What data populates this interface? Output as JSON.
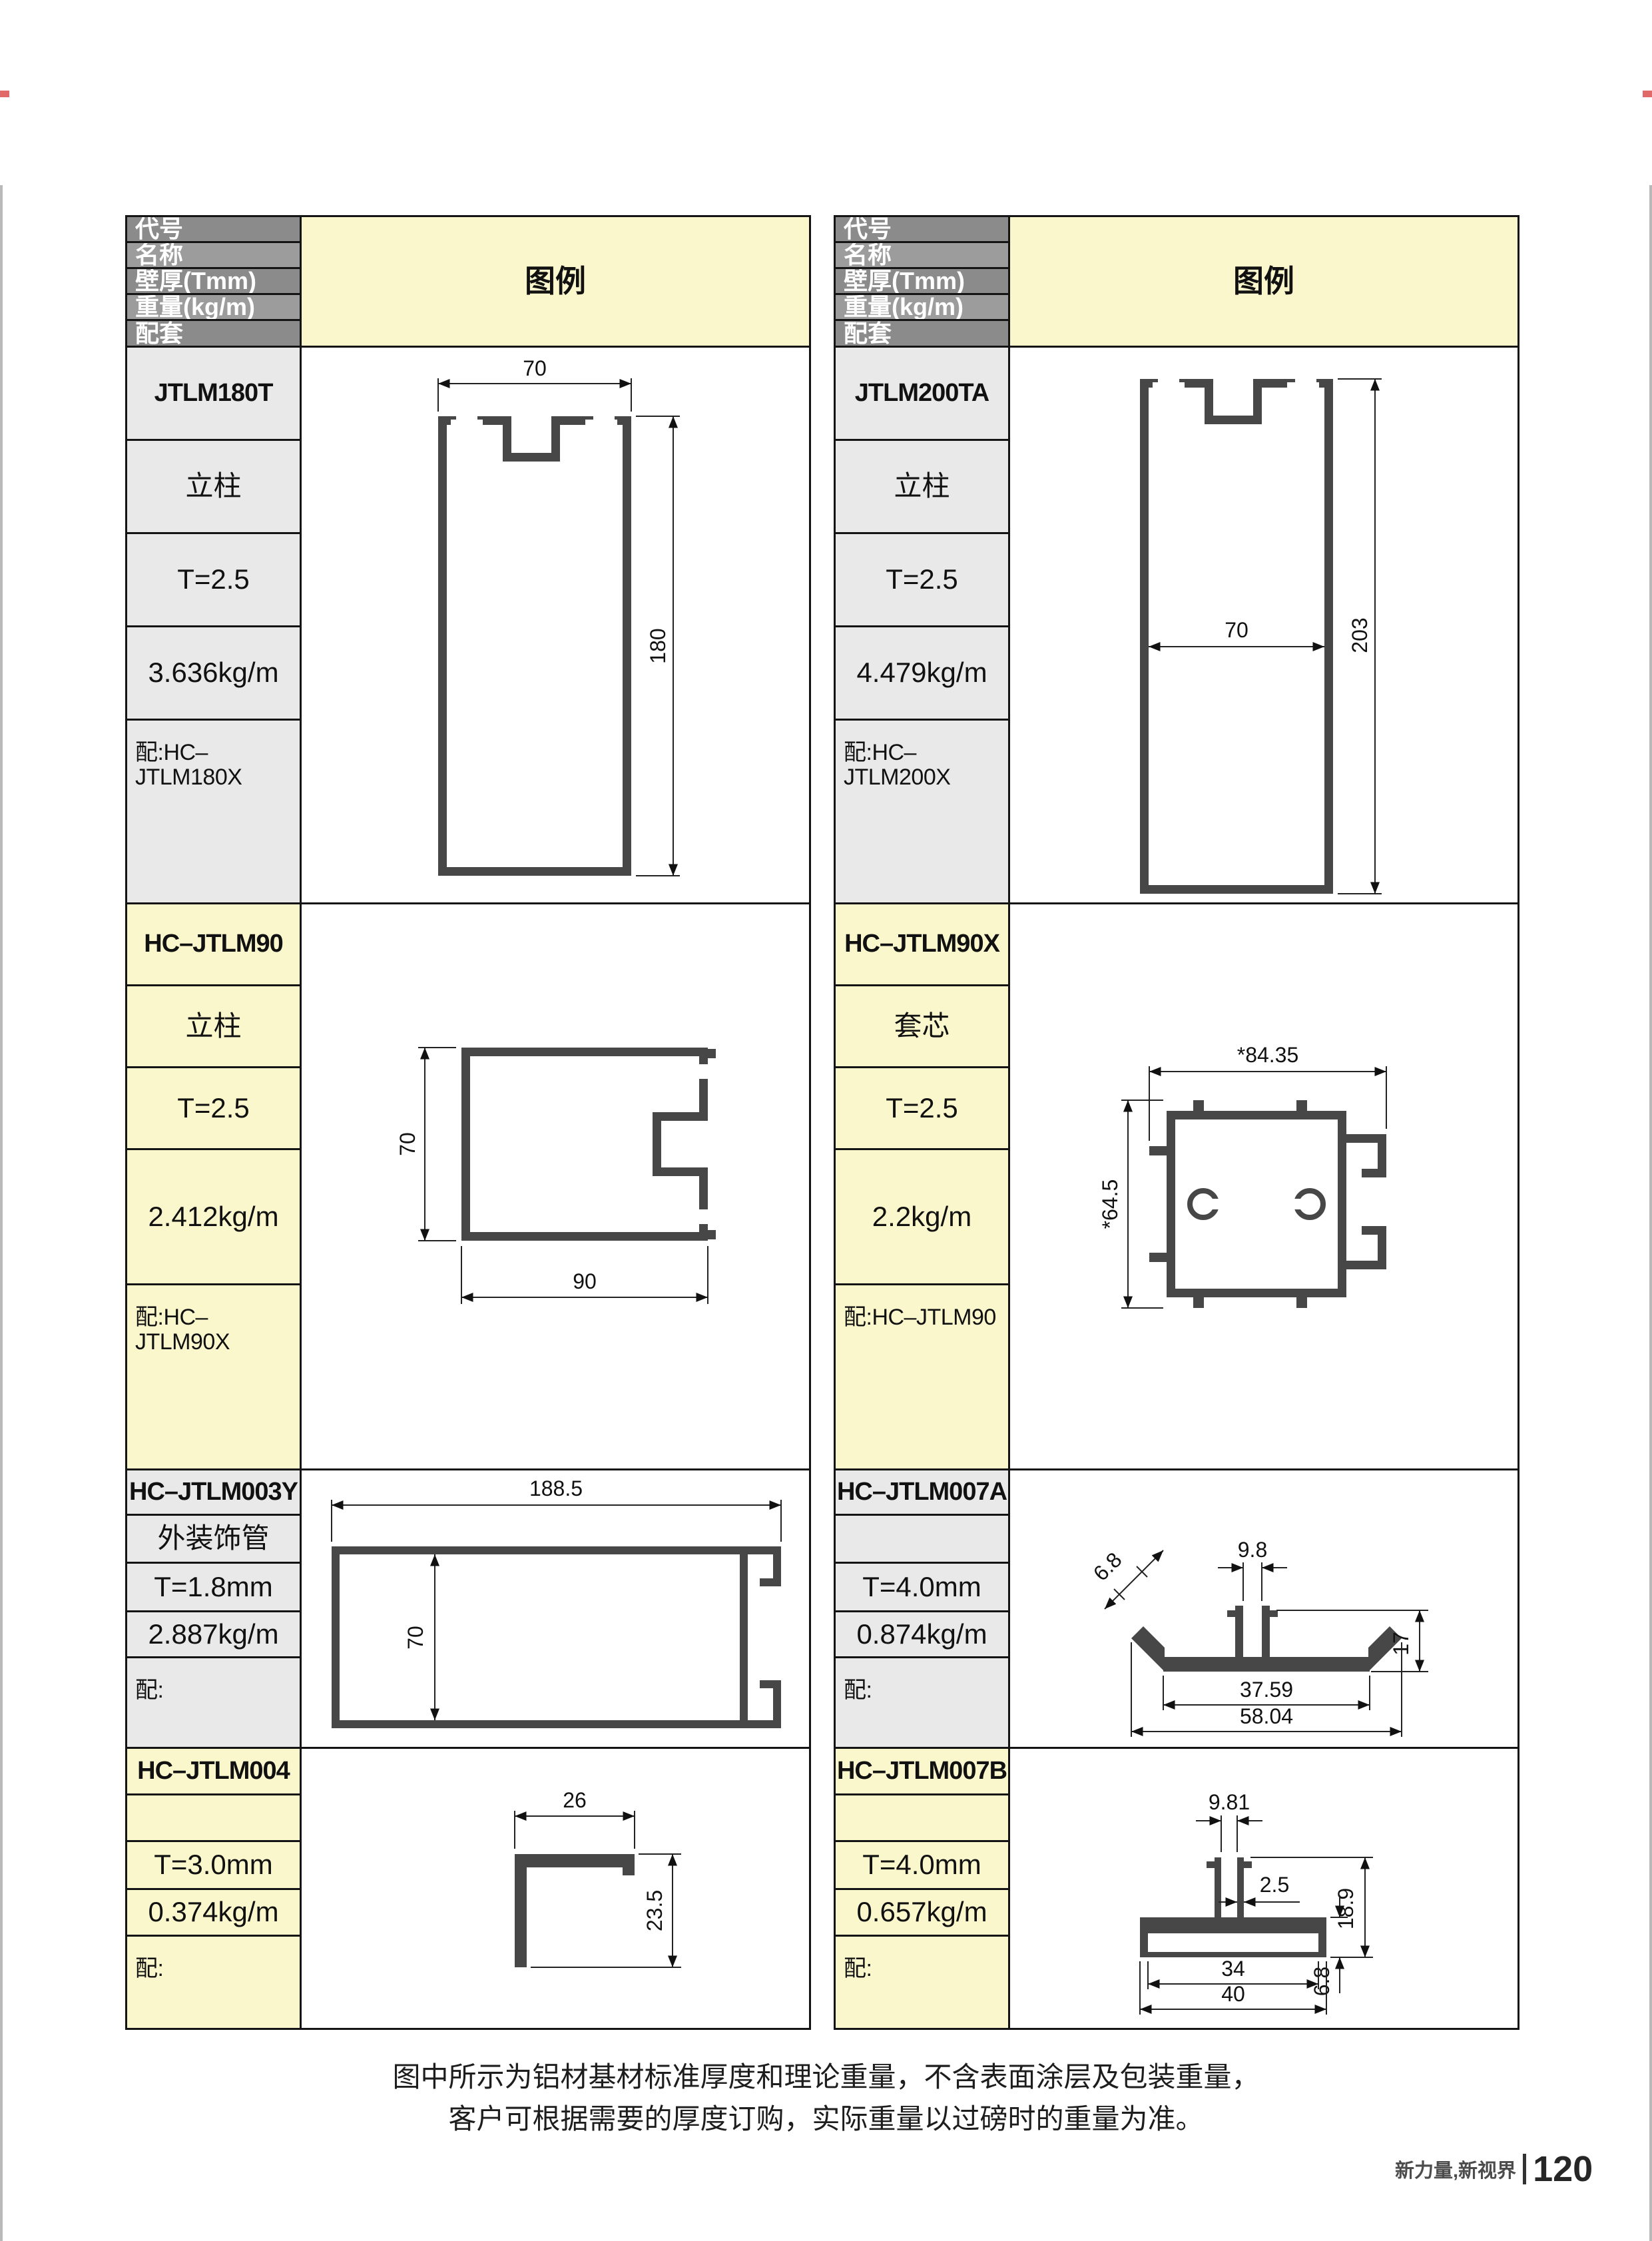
{
  "header": {
    "code": "代号",
    "name": "名称",
    "thickness": "壁厚(Tmm)",
    "weight": "重量(kg/m)",
    "match": "配套",
    "legend": "图例"
  },
  "tables": {
    "left": {
      "rows": [
        {
          "code": "JTLM180T",
          "name": "立柱",
          "thickness": "T=2.5",
          "weight": "3.636kg/m",
          "match": "配:HC–JTLM180X"
        },
        {
          "code": "HC–JTLM90",
          "name": "立柱",
          "thickness": "T=2.5",
          "weight": "2.412kg/m",
          "match": "配:HC–JTLM90X"
        },
        {
          "code": "HC–JTLM003Y",
          "name": "外装饰管",
          "thickness": "T=1.8mm",
          "weight": "2.887kg/m",
          "match": "配:"
        },
        {
          "code": "HC–JTLM004",
          "name": "",
          "thickness": "T=3.0mm",
          "weight": "0.374kg/m",
          "match": "配:"
        }
      ]
    },
    "right": {
      "rows": [
        {
          "code": "JTLM200TA",
          "name": "立柱",
          "thickness": "T=2.5",
          "weight": "4.479kg/m",
          "match": "配:HC–JTLM200X"
        },
        {
          "code": "HC–JTLM90X",
          "name": "套芯",
          "thickness": "T=2.5",
          "weight": "2.2kg/m",
          "match": "配:HC–JTLM90"
        },
        {
          "code": "HC–JTLM007A",
          "name": "",
          "thickness": "T=4.0mm",
          "weight": "0.874kg/m",
          "match": "配:"
        },
        {
          "code": "HC–JTLM007B",
          "name": "",
          "thickness": "T=4.0mm",
          "weight": "0.657kg/m",
          "match": "配:"
        }
      ]
    }
  },
  "drawings": {
    "jtlm180t": {
      "width": "70",
      "height": "180"
    },
    "jtlm200ta": {
      "width": "70",
      "height": "203"
    },
    "jtlm90": {
      "height": "70",
      "width": "90"
    },
    "jtlm90x": {
      "width": "*84.35",
      "height": "*64.5"
    },
    "jtlm003y": {
      "width": "188.5",
      "height": "70"
    },
    "jtlm007a": {
      "wing": "6.8",
      "slot": "9.8",
      "height": "17",
      "inner": "37.59",
      "outer": "58.04"
    },
    "jtlm004": {
      "width": "26",
      "height": "23.5"
    },
    "jtlm007b": {
      "slot": "9.81",
      "web": "2.5",
      "height": "18.9",
      "inner": "34",
      "outer": "40",
      "base": "6.8"
    }
  },
  "notes": {
    "line1": "图中所示为铝材基材标准厚度和理论重量，不含表面涂层及包装重量，",
    "line2": "客户可根据需要的厚度订购，实际重量以过磅时的重量为准。"
  },
  "footer": {
    "brand": "新力量,新视界",
    "page": "120"
  },
  "colors": {
    "row_gray": "#e9e9e9",
    "row_yellow": "#fbf7cd",
    "header_dark": "#8b8b8b",
    "header_light": "#9c9c9c",
    "border": "#141414",
    "profile_fill": "#474747",
    "page_bg": "#ffffff"
  }
}
